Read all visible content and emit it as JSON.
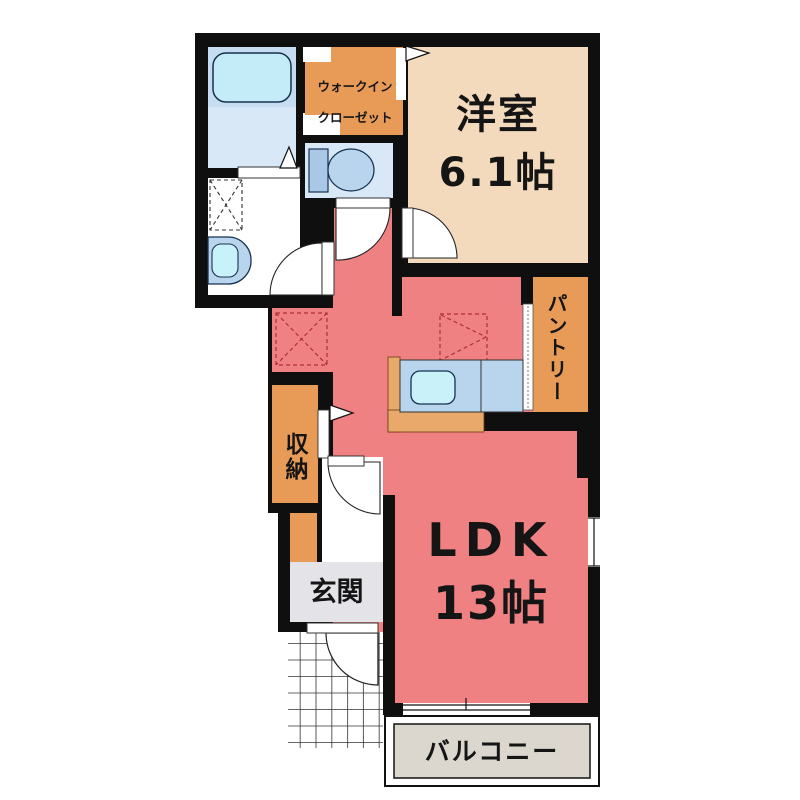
{
  "plan": {
    "type": "japanese-apartment-floorplan",
    "rooms": {
      "western_room": {
        "name": "洋室",
        "size": "6.1帖",
        "color": "#f3dabc"
      },
      "ldk": {
        "name": "LDK",
        "size": "13帖",
        "color": "#ef8183"
      },
      "walk_in_closet": {
        "name_line1": "ウォークイン",
        "name_line2": "クローゼット",
        "color": "#e89b56"
      },
      "pantry": {
        "name": "パントリー",
        "color": "#e89b56"
      },
      "storage": {
        "name": "収納",
        "color": "#e89b56"
      },
      "entrance": {
        "name": "玄関",
        "color": "#e4e4e8"
      },
      "balcony": {
        "name": "バルコニー",
        "color": "#dbd7cf"
      },
      "bathroom": {
        "name": "",
        "color": "#d9e8f6"
      },
      "toilet": {
        "name": "",
        "color": "#d9e8f6"
      },
      "washroom": {
        "name": "",
        "color": "#ffffff"
      }
    },
    "fixtures": [
      "bathtub",
      "toilet-bowl",
      "washbasin",
      "kitchen-counter-sink",
      "washing-machine-space",
      "refrigerator-space"
    ],
    "colors": {
      "wall": "#0f0f0f",
      "background": "#ffffff",
      "fixture_blue": "#b9d5ee",
      "sink_blue": "#c9f1fa",
      "kitchen_base": "#e9a96b"
    }
  }
}
